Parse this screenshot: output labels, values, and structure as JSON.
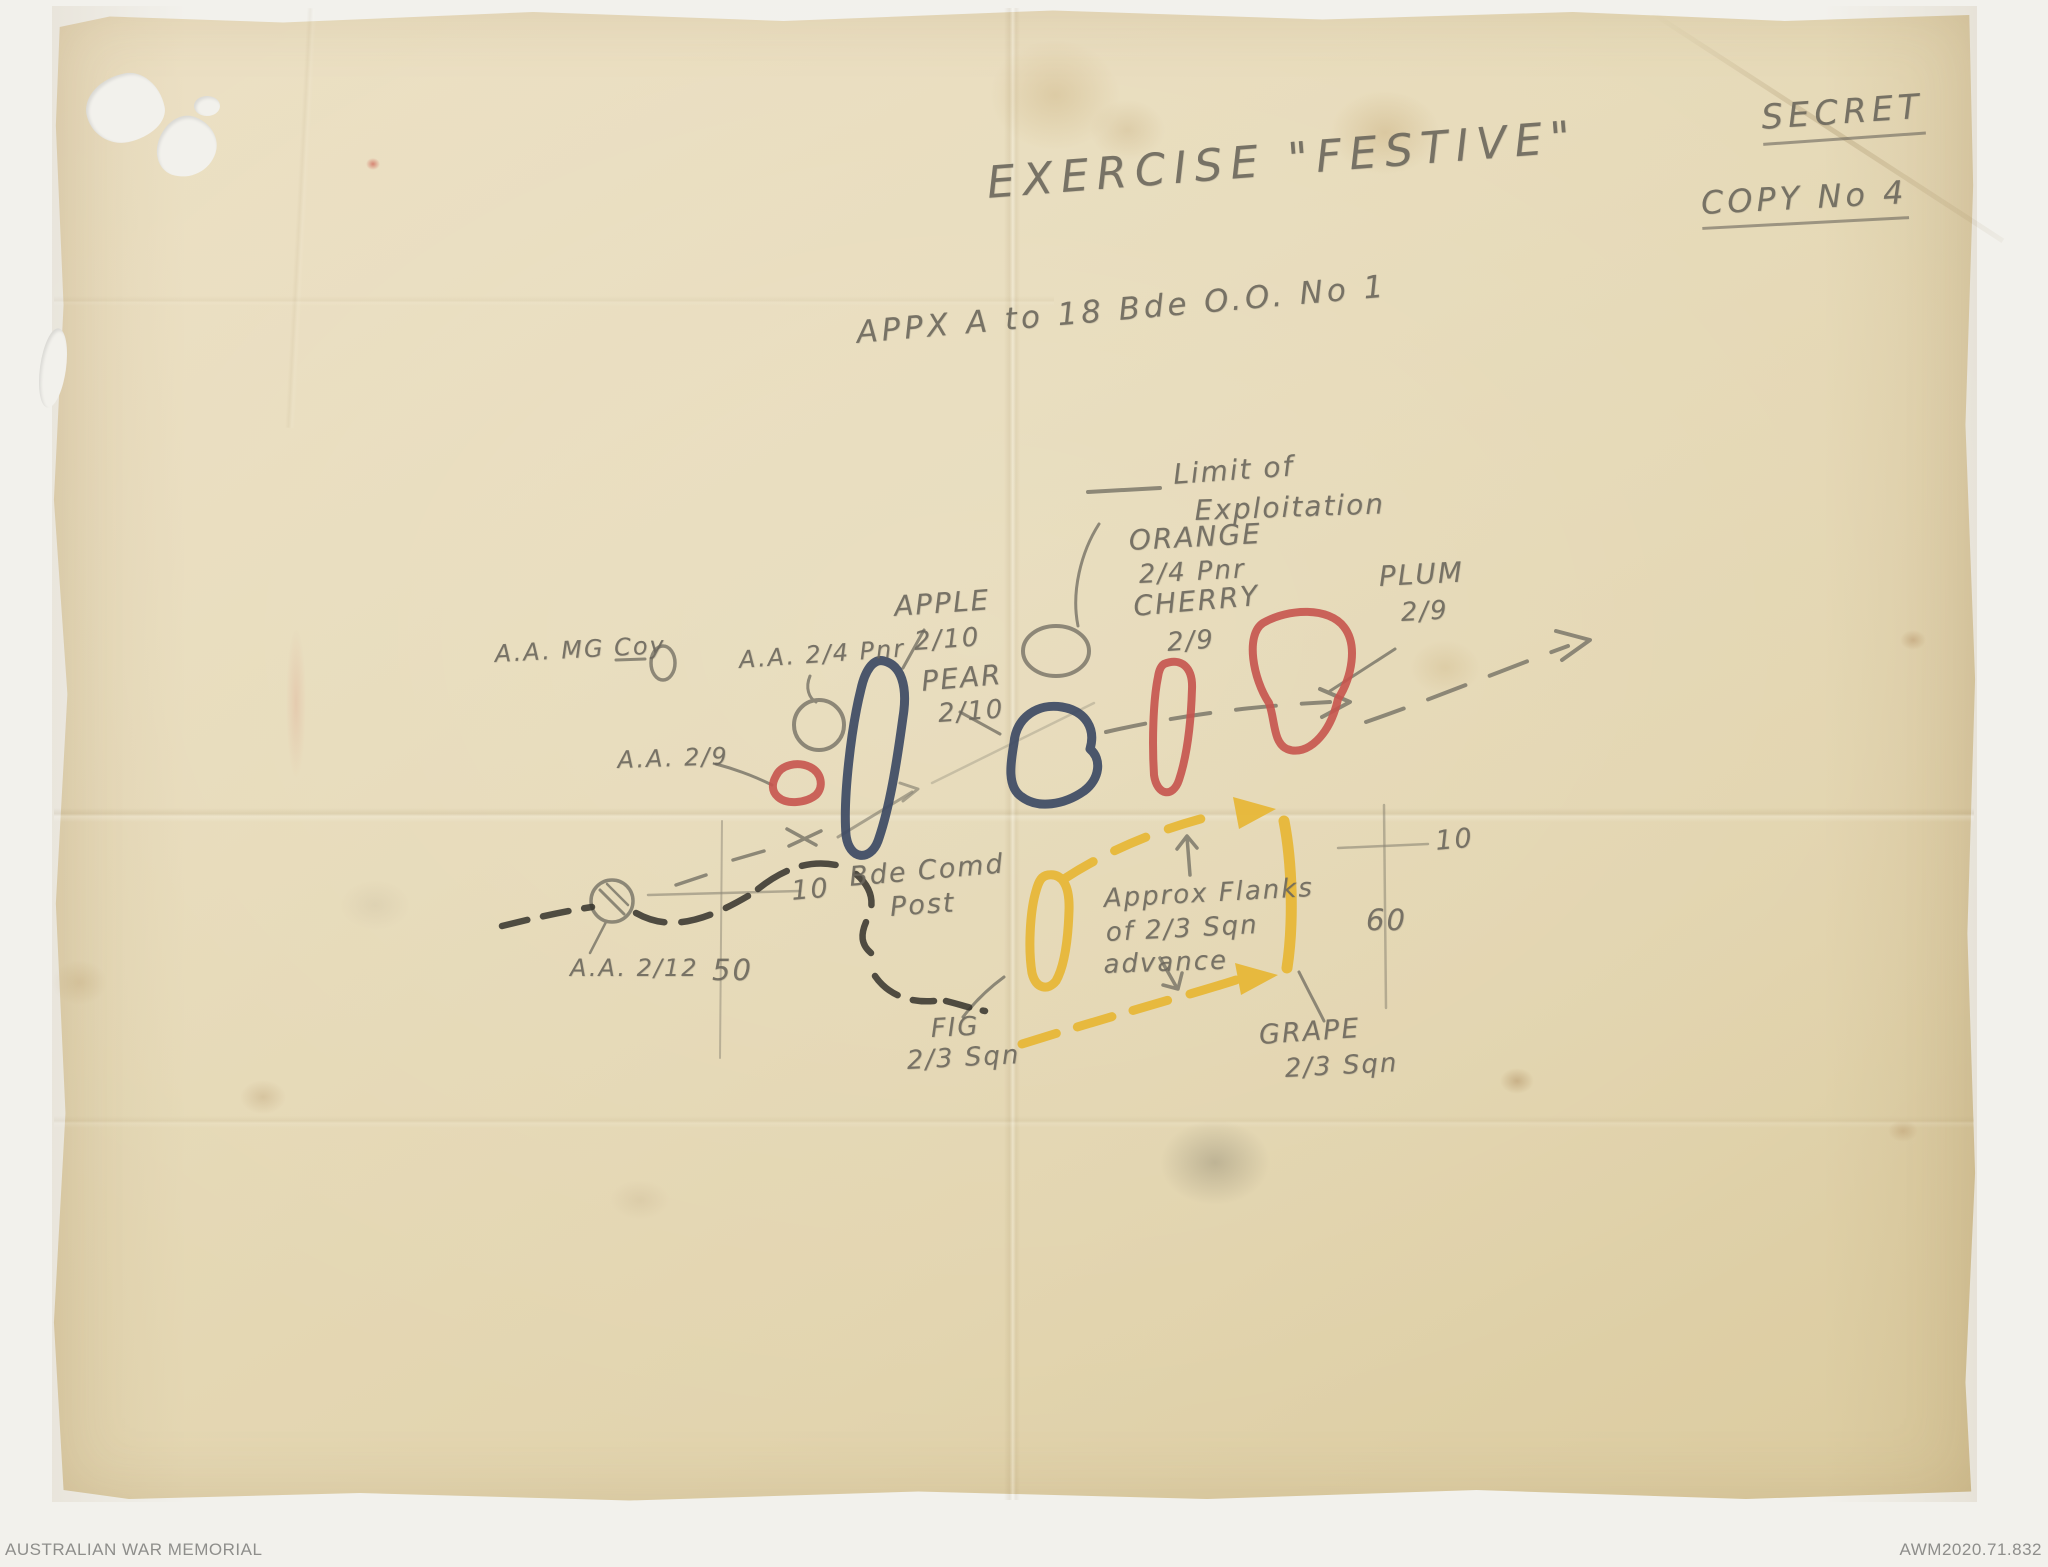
{
  "document": {
    "classification": "SECRET",
    "copy_number": "COPY No 4",
    "title": "EXERCISE \"FESTIVE\"",
    "appendix": "APPX A to 18 Bde O.O. No 1"
  },
  "legend": {
    "limit_line1": "Limit of",
    "limit_line2": "Exploitation"
  },
  "objectives": {
    "orange": {
      "name": "ORANGE",
      "unit": "2/4 Pnr"
    },
    "cherry": {
      "name": "CHERRY",
      "unit": "2/9"
    },
    "plum": {
      "name": "PLUM",
      "unit": "2/9"
    },
    "apple": {
      "name": "APPLE",
      "unit": "2/10"
    },
    "pear": {
      "name": "PEAR",
      "unit": "2/10"
    },
    "fig": {
      "name": "FIG",
      "unit": "2/3 Sqn"
    },
    "grape": {
      "name": "GRAPE",
      "unit": "2/3 Sqn"
    }
  },
  "positions": {
    "aa_mg_coy": "A.A. MG Coy",
    "aa_2_4_pnr": "A.A. 2/4 Pnr",
    "aa_2_9": "A.A. 2/9",
    "aa_2_12": "A.A. 2/12",
    "bde_comd_line1": "Bde Comd",
    "bde_comd_line2": "Post"
  },
  "annotations": {
    "flanks_line1": "Approx Flanks",
    "flanks_line2": "of 2/3 Sqn",
    "flanks_line3": "advance"
  },
  "grid": {
    "west_cross_easting": "10",
    "west_cross_northing": "50",
    "east_cross_easting": "10",
    "east_cross_northing": "60"
  },
  "scan_footer": {
    "archive": "AUSTRALIAN WAR MEMORIAL",
    "reference": "AWM2020.71.832"
  },
  "colors": {
    "pencil": "#6b675c",
    "charcoal": "#34322c",
    "objective_blue": "#3d4a64",
    "objective_red": "#c6544e",
    "flank_yellow": "#e7b838",
    "paper": "#e5d9b6"
  }
}
